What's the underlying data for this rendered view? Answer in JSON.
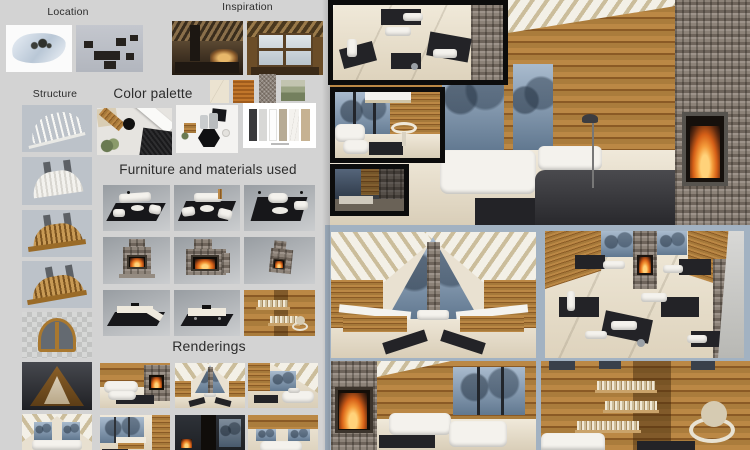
{
  "titles": {
    "location": "Location",
    "inspiration": "Inspiration",
    "structure": "Structure",
    "color_palette": "Color palette",
    "furniture": "Furniture and materials used",
    "renderings": "Renderings"
  },
  "color_palette": {
    "swatches": [
      {
        "name": "cream-marble",
        "color": "#ebe3d1"
      },
      {
        "name": "orange-striped-wood",
        "color": "#c1762a"
      },
      {
        "name": "grey-stone",
        "color": "#8b8178"
      },
      {
        "name": "green-landscape-art",
        "color": "#9aa383"
      }
    ]
  },
  "key_colors": {
    "board_background": "#d3d3d3",
    "wood": "#a6793a",
    "stone_grey": "#847a70",
    "floor_cream": "#ece4d3",
    "dusk_window": "#7f93a9",
    "inset_border_black": "#0c0c0c",
    "bottom_frame_blue_grey": "#a2b2c2",
    "fire_orange": "#e07020"
  }
}
